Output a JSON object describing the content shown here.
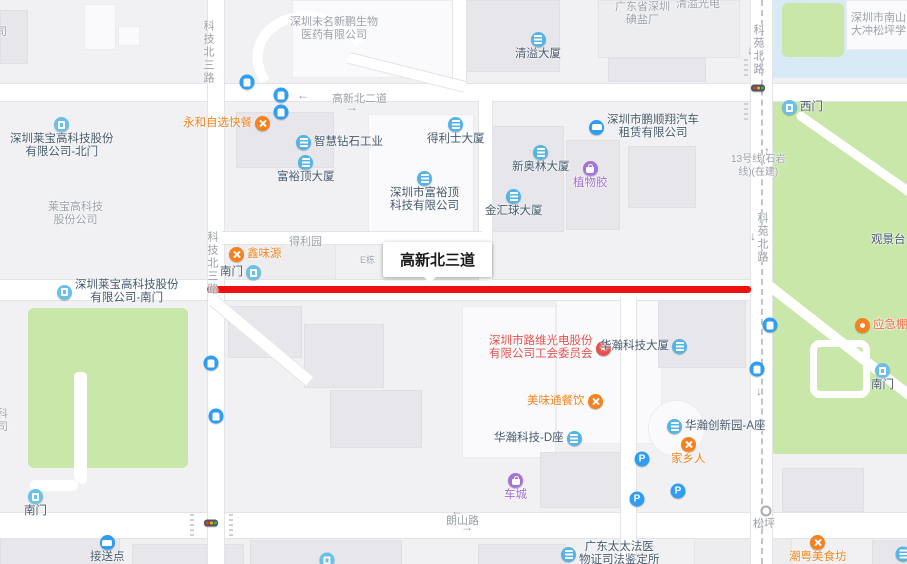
{
  "map": {
    "background": "#f1f1f4",
    "road_color": "#ffffff",
    "park_color": "#c9e7a9",
    "water_color": "#d8eaf6",
    "red_highlight_color": "#ee1111",
    "poi_text_color": "#44586e",
    "road_text_color": "#9aa0a8"
  },
  "callout": {
    "text": "高新北三道"
  },
  "colors": {
    "default": "#44586e",
    "orange": "#f0821e",
    "purple": "#a06cd5",
    "red": "#e4504c",
    "orangered": "#ed6a45"
  },
  "labels": [
    {
      "name": "road-label-keji-north-3rd-top",
      "lines": [
        "科技北三路"
      ],
      "x": 201,
      "y": 20,
      "vert": true
    },
    {
      "name": "road-label-keji-north-3rd-mid",
      "lines": [
        "科技北三路"
      ],
      "x": 205,
      "y": 231,
      "vert": true
    },
    {
      "name": "road-label-keyuan-north-top",
      "lines": [
        "科苑北路"
      ],
      "x": 751,
      "y": 24,
      "vert": true
    },
    {
      "name": "road-label-keyuan-north-mid",
      "lines": [
        "科苑北路"
      ],
      "x": 755,
      "y": 212,
      "vert": true
    },
    {
      "name": "road-label-gaoxin-north-2nd",
      "lines": [
        "高新北二道"
      ],
      "x": 332,
      "y": 93
    },
    {
      "name": "road-label-langshan",
      "lines": [
        "朗山路"
      ],
      "x": 446,
      "y": 515
    },
    {
      "name": "road-label-songping",
      "lines": [
        "松坪"
      ],
      "x": 753,
      "y": 518
    },
    {
      "name": "label-metro-line13",
      "lines": [
        "13号线(石岩",
        "线)(在建)"
      ],
      "x": 731,
      "y": 153,
      "size": 10
    },
    {
      "name": "area-label-laibao",
      "lines": [
        "莱宝高科技",
        "股份公司"
      ],
      "x": 48,
      "y": 201
    },
    {
      "name": "area-label-weiming-biotech",
      "lines": [
        "深圳未名新鹏生物",
        "医药有限公司"
      ],
      "x": 290,
      "y": 16
    },
    {
      "name": "area-label-iodized-salt-factory",
      "lines": [
        "广东省深圳",
        "碘盐厂"
      ],
      "x": 615,
      "y": 1
    },
    {
      "name": "area-label-dachong-school",
      "lines": [
        "深圳市南山",
        "大冲松坪学"
      ],
      "x": 851,
      "y": 12
    },
    {
      "name": "area-label-qingyi-guangdian",
      "lines": [
        "清溢光电"
      ],
      "x": 676,
      "y": -2
    },
    {
      "name": "area-label-deliyuan",
      "lines": [
        "得利园"
      ],
      "x": 289,
      "y": 236
    },
    {
      "name": "area-label-e-block",
      "lines": [
        "E栋"
      ],
      "x": 360,
      "y": 254,
      "size": 9
    },
    {
      "name": "area-label-edge-top",
      "lines": [
        "司"
      ],
      "x": -4,
      "y": 26
    },
    {
      "name": "area-label-edge-mid",
      "lines": [
        "科",
        "司"
      ],
      "x": -3,
      "y": 408
    }
  ],
  "pois": [
    {
      "name": "poi-laibao-north-gate",
      "lines": [
        "深圳莱宝高科技股份",
        "有限公司-北门"
      ],
      "x": 10,
      "y": 117,
      "icon": "door",
      "pos": "t"
    },
    {
      "name": "poi-yonghe-fastfood",
      "lines": [
        "永和自选快餐"
      ],
      "x": 183,
      "y": 116,
      "icon": "food",
      "pos": "r",
      "color": "orange"
    },
    {
      "name": "poi-xinweiyuan",
      "lines": [
        "鑫味源"
      ],
      "x": 229,
      "y": 247,
      "icon": "food",
      "pos": "l",
      "color": "orange"
    },
    {
      "name": "poi-south-gate-keji-rd",
      "lines": [
        "南门"
      ],
      "x": 220,
      "y": 265,
      "icon": "door",
      "pos": "r"
    },
    {
      "name": "poi-laibao-south-gate",
      "lines": [
        "深圳莱宝高科技股份",
        "有限公司-南门"
      ],
      "x": 57,
      "y": 279,
      "icon": "door",
      "pos": "l"
    },
    {
      "name": "poi-south-gate-left-park",
      "lines": [
        "南门"
      ],
      "x": 24,
      "y": 489,
      "icon": "door",
      "pos": "t"
    },
    {
      "name": "poi-pickup-point",
      "lines": [
        "接送点"
      ],
      "x": 90,
      "y": 535,
      "icon": "car",
      "pos": "t"
    },
    {
      "name": "poi-zhihui-diamond-industry",
      "lines": [
        "智慧钻石工业"
      ],
      "x": 296,
      "y": 135,
      "icon": "bld-i",
      "pos": "l"
    },
    {
      "name": "poi-fuyuding-tower",
      "lines": [
        "富裕顶大厦"
      ],
      "x": 277,
      "y": 155,
      "icon": "bld-i",
      "pos": "t"
    },
    {
      "name": "poi-fuyuding-tech",
      "lines": [
        "深圳市富裕顶",
        "科技有限公司"
      ],
      "x": 390,
      "y": 171,
      "icon": "bld-i",
      "pos": "t"
    },
    {
      "name": "poi-delishi-tower",
      "lines": [
        "得利士大厦"
      ],
      "x": 427,
      "y": 117,
      "icon": "bld-i",
      "pos": "t"
    },
    {
      "name": "poi-jinhuiqiu-tower",
      "lines": [
        "金汇球大厦"
      ],
      "x": 485,
      "y": 189,
      "icon": "bld-i",
      "pos": "t"
    },
    {
      "name": "poi-xinaolin-tower",
      "lines": [
        "新奥林大厦"
      ],
      "x": 512,
      "y": 145,
      "icon": "bld-i",
      "pos": "t"
    },
    {
      "name": "poi-qingyi-tower",
      "lines": [
        "清溢大厦"
      ],
      "x": 515,
      "y": 32,
      "icon": "bld-i",
      "pos": "t"
    },
    {
      "name": "poi-zhiwujiao",
      "lines": [
        "植物胶"
      ],
      "x": 573,
      "y": 161,
      "icon": "bag",
      "pos": "t",
      "color": "purple"
    },
    {
      "name": "poi-pengshunxiang-car-rental",
      "lines": [
        "深圳市鹏顺翔汽车",
        "租赁有限公司"
      ],
      "x": 589,
      "y": 114,
      "icon": "car",
      "pos": "l"
    },
    {
      "name": "poi-west-gate-park",
      "lines": [
        "西门"
      ],
      "x": 782,
      "y": 100,
      "icon": "door",
      "pos": "l"
    },
    {
      "name": "poi-viewing-platform",
      "lines": [
        "观景台"
      ],
      "x": 871,
      "y": 233,
      "icon": "bag",
      "pos": "r"
    },
    {
      "name": "poi-emergency-shelter",
      "lines": [
        "应急棚宿"
      ],
      "x": 855,
      "y": 318,
      "icon": "shelter",
      "pos": "l",
      "color": "orangered"
    },
    {
      "name": "poi-south-gate-right-park",
      "lines": [
        "南门"
      ],
      "x": 871,
      "y": 363,
      "icon": "door",
      "pos": "t"
    },
    {
      "name": "poi-luwei-union-committee",
      "lines": [
        "深圳市路维光电股份",
        "有限公司工会委员会"
      ],
      "x": 489,
      "y": 335,
      "icon": "union",
      "pos": "r",
      "color": "red"
    },
    {
      "name": "poi-huahan-tower",
      "lines": [
        "华瀚科技大厦"
      ],
      "x": 600,
      "y": 339,
      "icon": "bld-i",
      "pos": "r"
    },
    {
      "name": "poi-meiweitong-catering",
      "lines": [
        "美味通餐饮"
      ],
      "x": 527,
      "y": 394,
      "icon": "food",
      "pos": "r",
      "color": "orange"
    },
    {
      "name": "poi-huahan-block-d",
      "lines": [
        "华瀚科技-D座"
      ],
      "x": 494,
      "y": 431,
      "icon": "bld-i",
      "pos": "r"
    },
    {
      "name": "poi-huahan-innovation-a",
      "lines": [
        "华瀚创新园-A座"
      ],
      "x": 667,
      "y": 419,
      "icon": "bld-i",
      "pos": "l"
    },
    {
      "name": "poi-jiaxiangren",
      "lines": [
        "家乡人"
      ],
      "x": 671,
      "y": 437,
      "icon": "food",
      "pos": "t",
      "color": "orange"
    },
    {
      "name": "poi-checheng",
      "lines": [
        "车城"
      ],
      "x": 504,
      "y": 473,
      "icon": "bag",
      "pos": "t",
      "color": "purple"
    },
    {
      "name": "poi-forensic-center",
      "lines": [
        "广东太太法医",
        "物证司法鉴定所"
      ],
      "x": 561,
      "y": 541,
      "icon": "bld-i",
      "pos": "l"
    },
    {
      "name": "poi-chaoyue-food",
      "lines": [
        "潮粤美食坊"
      ],
      "x": 789,
      "y": 535,
      "icon": "food",
      "pos": "t",
      "color": "orange"
    }
  ],
  "standalone_icons": [
    {
      "name": "bus-stop-icon",
      "type": "bus",
      "x": 247,
      "y": 82
    },
    {
      "name": "bus-stop-icon",
      "type": "bus",
      "x": 281,
      "y": 95
    },
    {
      "name": "bus-stop-icon",
      "type": "bus",
      "x": 281,
      "y": 112
    },
    {
      "name": "bus-stop-icon",
      "type": "bus",
      "x": 211,
      "y": 363
    },
    {
      "name": "bus-stop-icon",
      "type": "bus",
      "x": 216,
      "y": 416
    },
    {
      "name": "bus-stop-icon",
      "type": "bus",
      "x": 770,
      "y": 325
    },
    {
      "name": "bus-stop-icon",
      "type": "bus",
      "x": 757,
      "y": 369
    },
    {
      "name": "parking-icon",
      "type": "parking",
      "x": 642,
      "y": 459
    },
    {
      "name": "parking-icon",
      "type": "parking",
      "x": 678,
      "y": 491
    },
    {
      "name": "parking-icon",
      "type": "parking",
      "x": 637,
      "y": 499
    },
    {
      "name": "traffic-light-icon",
      "type": "traffic",
      "x": 758,
      "y": 88
    },
    {
      "name": "traffic-light-icon",
      "type": "traffic",
      "x": 211,
      "y": 523
    },
    {
      "name": "songping-station-marker",
      "type": "station",
      "x": 766,
      "y": 511
    },
    {
      "name": "gate-icon",
      "type": "door",
      "x": 327,
      "y": 560
    },
    {
      "name": "building-icon",
      "type": "bld-i",
      "x": 903,
      "y": 554
    }
  ],
  "arrows": [
    {
      "glyph": "←",
      "x": 303,
      "y": 95
    },
    {
      "glyph": "→",
      "x": 352,
      "y": 107
    },
    {
      "glyph": "↓",
      "x": 750,
      "y": 50
    },
    {
      "glyph": "↓",
      "x": 753,
      "y": 236
    },
    {
      "glyph": "↑",
      "x": 767,
      "y": 151
    },
    {
      "glyph": "↓",
      "x": 759,
      "y": 391
    },
    {
      "glyph": "←",
      "x": 457,
      "y": 511
    },
    {
      "glyph": "→",
      "x": 467,
      "y": 527
    }
  ]
}
